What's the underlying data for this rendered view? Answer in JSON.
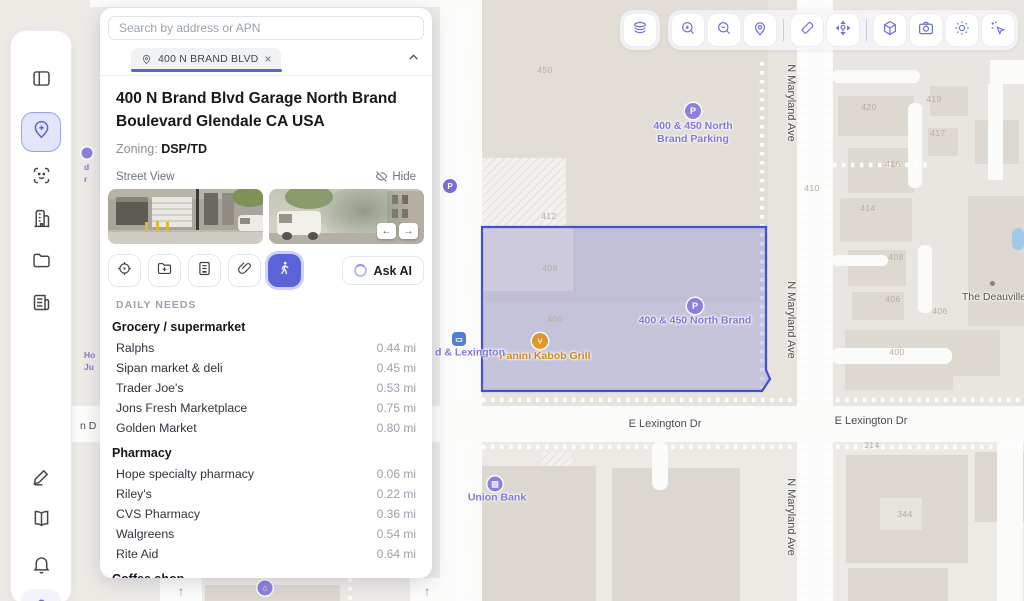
{
  "panel": {
    "search": {
      "placeholder": "Search by address or APN"
    },
    "tab": {
      "label": "400 N BRAND BLVD",
      "close": "×"
    },
    "property": {
      "title": "400 N Brand Blvd Garage North Brand Boulevard Glendale CA USA",
      "zoning_label": "Zoning:",
      "zoning_value": "DSP/TD"
    },
    "street_view": {
      "label": "Street View",
      "hide_label": "Hide",
      "prev": "←",
      "next": "→"
    },
    "action_icons": [
      "locate-target",
      "folder-add",
      "file-export",
      "attachment",
      "walk-distance (active)"
    ],
    "ask_ai_label": "Ask AI",
    "daily_needs": {
      "header": "DAILY NEEDS",
      "grocery": {
        "title": "Grocery / supermarket",
        "items": [
          {
            "name": "Ralphs",
            "dist": "0.44 mi"
          },
          {
            "name": "Sipan market & deli",
            "dist": "0.45 mi"
          },
          {
            "name": "Trader Joe's",
            "dist": "0.53 mi"
          },
          {
            "name": "Jons Fresh Marketplace",
            "dist": "0.75 mi"
          },
          {
            "name": "Golden Market",
            "dist": "0.80 mi"
          }
        ]
      },
      "pharmacy": {
        "title": "Pharmacy",
        "items": [
          {
            "name": "Hope specialty pharmacy",
            "dist": "0.06 mi"
          },
          {
            "name": "Riley's",
            "dist": "0.22 mi"
          },
          {
            "name": "CVS Pharmacy",
            "dist": "0.36 mi"
          },
          {
            "name": "Walgreens",
            "dist": "0.54 mi"
          },
          {
            "name": "Rite Aid",
            "dist": "0.64 mi"
          }
        ]
      },
      "coffee": {
        "title": "Coffee shop"
      }
    }
  },
  "sidebar": {
    "items": [
      "panel-toggle",
      "parcel-pin (active)",
      "face-scan",
      "building",
      "folder",
      "news-doc",
      "pencil-edit",
      "book-open",
      "bell",
      "user (highlighted)"
    ]
  },
  "toolbar": {
    "groups": [
      [
        "map-layers"
      ],
      [
        "zoom-in",
        "zoom-out",
        "location-pin",
        "|",
        "eraser",
        "move-pin",
        "|",
        "cube-3d",
        "camera",
        "brightness",
        "cursor-sparkle"
      ]
    ]
  },
  "map": {
    "streets": {
      "milford": "W Milford St",
      "lexington": "E Lexington Dr",
      "maryland": "N Maryland Ave"
    },
    "pois": {
      "parking_lot_line1": "400 & 450 North",
      "parking_lot_line2": "Brand Parking",
      "garage": "400 & 450 North Brand",
      "panini": "Panini Kabob Grill",
      "union_bank": "Union Bank",
      "deauville": "The Deauville",
      "transit_stop": "d & Lexington",
      "marker_p": "P"
    },
    "fragments": {
      "a": "d",
      "b": "r",
      "c": "Ho",
      "d": "Ju",
      "e": "n D"
    },
    "parcels": [
      {
        "t": "450",
        "x": 545,
        "y": 70
      },
      {
        "t": "412",
        "x": 549,
        "y": 216
      },
      {
        "t": "408",
        "x": 550,
        "y": 268
      },
      {
        "t": "400",
        "x": 555,
        "y": 319
      },
      {
        "t": "420",
        "x": 869,
        "y": 107
      },
      {
        "t": "419",
        "x": 934,
        "y": 99
      },
      {
        "t": "417",
        "x": 938,
        "y": 133
      },
      {
        "t": "416",
        "x": 893,
        "y": 164
      },
      {
        "t": "410",
        "x": 812,
        "y": 188
      },
      {
        "t": "414",
        "x": 868,
        "y": 208
      },
      {
        "t": "408",
        "x": 896,
        "y": 257
      },
      {
        "t": "406",
        "x": 893,
        "y": 299
      },
      {
        "t": "406",
        "x": 940,
        "y": 311
      },
      {
        "t": "400",
        "x": 897,
        "y": 352
      },
      {
        "t": "214",
        "x": 872,
        "y": 445
      },
      {
        "t": "344",
        "x": 905,
        "y": 514
      }
    ],
    "colors": {
      "accent": "#5b63d8",
      "parcel_fill": "rgba(99,106,210,0.26)",
      "parcel_stroke": "#4152cc",
      "poi_purple": "#8276d8",
      "poi_orange": "#c9881e"
    }
  }
}
